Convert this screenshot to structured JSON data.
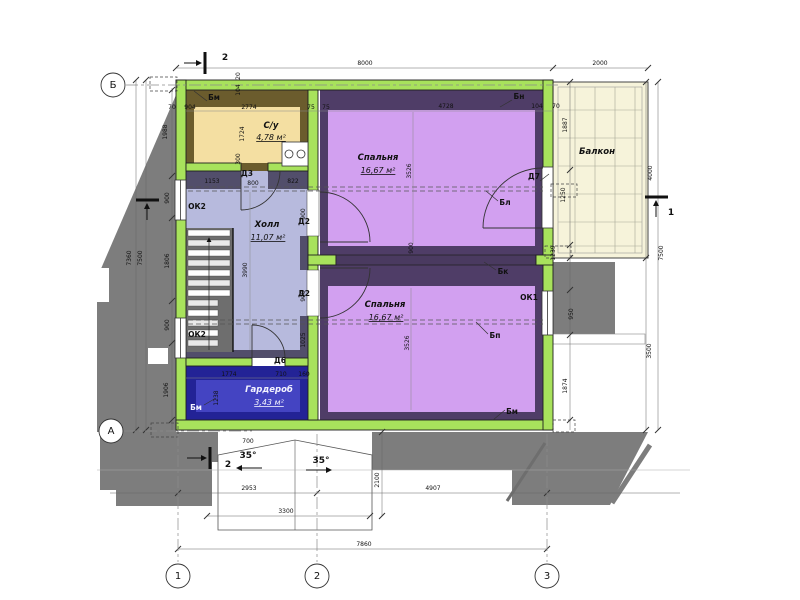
{
  "plan": {
    "axes": {
      "b": "Б",
      "a": "А",
      "c1": "1",
      "c2": "2",
      "c3": "3"
    },
    "rooms": {
      "bathroom": {
        "name": "С/у",
        "area": "4,78 м²"
      },
      "bedroom_top": {
        "name": "Спальня",
        "area": "16,67 м²"
      },
      "hall": {
        "name": "Холл",
        "area": "11,07 м²"
      },
      "bedroom_bottom": {
        "name": "Спальня",
        "area": "16,67 м²"
      },
      "wardrobe": {
        "name": "Гардероб",
        "area": "3,43 м²"
      },
      "balcony": {
        "name": "Балкон"
      }
    },
    "tags": {
      "d2": "Д2",
      "d3": "Д3",
      "d6": "Д6",
      "d7": "Д7",
      "ok1": "ОК1",
      "ok2": "ОК2",
      "bm": "Бм",
      "bn": "Бн",
      "bl": "Бл",
      "bk": "Бк",
      "bp": "Бп"
    },
    "sections": {
      "s1": "1",
      "s2": "2"
    },
    "slopes": {
      "left": "35°",
      "right": "35°"
    },
    "dims": {
      "top_total": "8000",
      "top_balcony": "2000",
      "top_inner": [
        "70",
        "904",
        "2774",
        "75",
        "75",
        "4728",
        "104",
        "70"
      ],
      "wall_layers": [
        "20",
        "104"
      ],
      "left_outer": [
        "7360",
        "7500"
      ],
      "left_chain": [
        "1988",
        "900",
        "1806",
        "900",
        "1906"
      ],
      "right_chain": [
        "1887",
        "1250",
        "1239",
        "950",
        "1874"
      ],
      "right_outer": [
        "4000",
        "7500",
        "3500"
      ],
      "bath": {
        "h": "1724",
        "v": "300"
      },
      "hall_top": [
        "1153",
        "800",
        "822"
      ],
      "hall": {
        "h": "3990",
        "door": "900",
        "door2": "900",
        "v": "1025"
      },
      "bed_top": {
        "h": "3526",
        "door": "900"
      },
      "bed_bottom": {
        "h": "3526"
      },
      "wardrobe_line": [
        "1774",
        "710",
        "160"
      ],
      "wardrobe_v": "1238",
      "bottom": [
        "2953",
        "4907",
        "3300",
        "7860"
      ],
      "porch": {
        "w": "700",
        "h": "2100"
      }
    },
    "colors": {
      "wall_green": "#a8e25c",
      "bedroom_fill": "#d2a0f0",
      "bedroom_poche": "#4f3d67",
      "hall_fill": "#b7badd",
      "hall_poche": "#524e6b",
      "bath_fill": "#f4dfa2",
      "bath_poche": "#6b5c2d",
      "wardrobe_fill": "#4444c2",
      "wardrobe_poche": "#232396",
      "balcony_fill": "#f6f3da",
      "roof_gray": "#7d7d7d"
    }
  }
}
